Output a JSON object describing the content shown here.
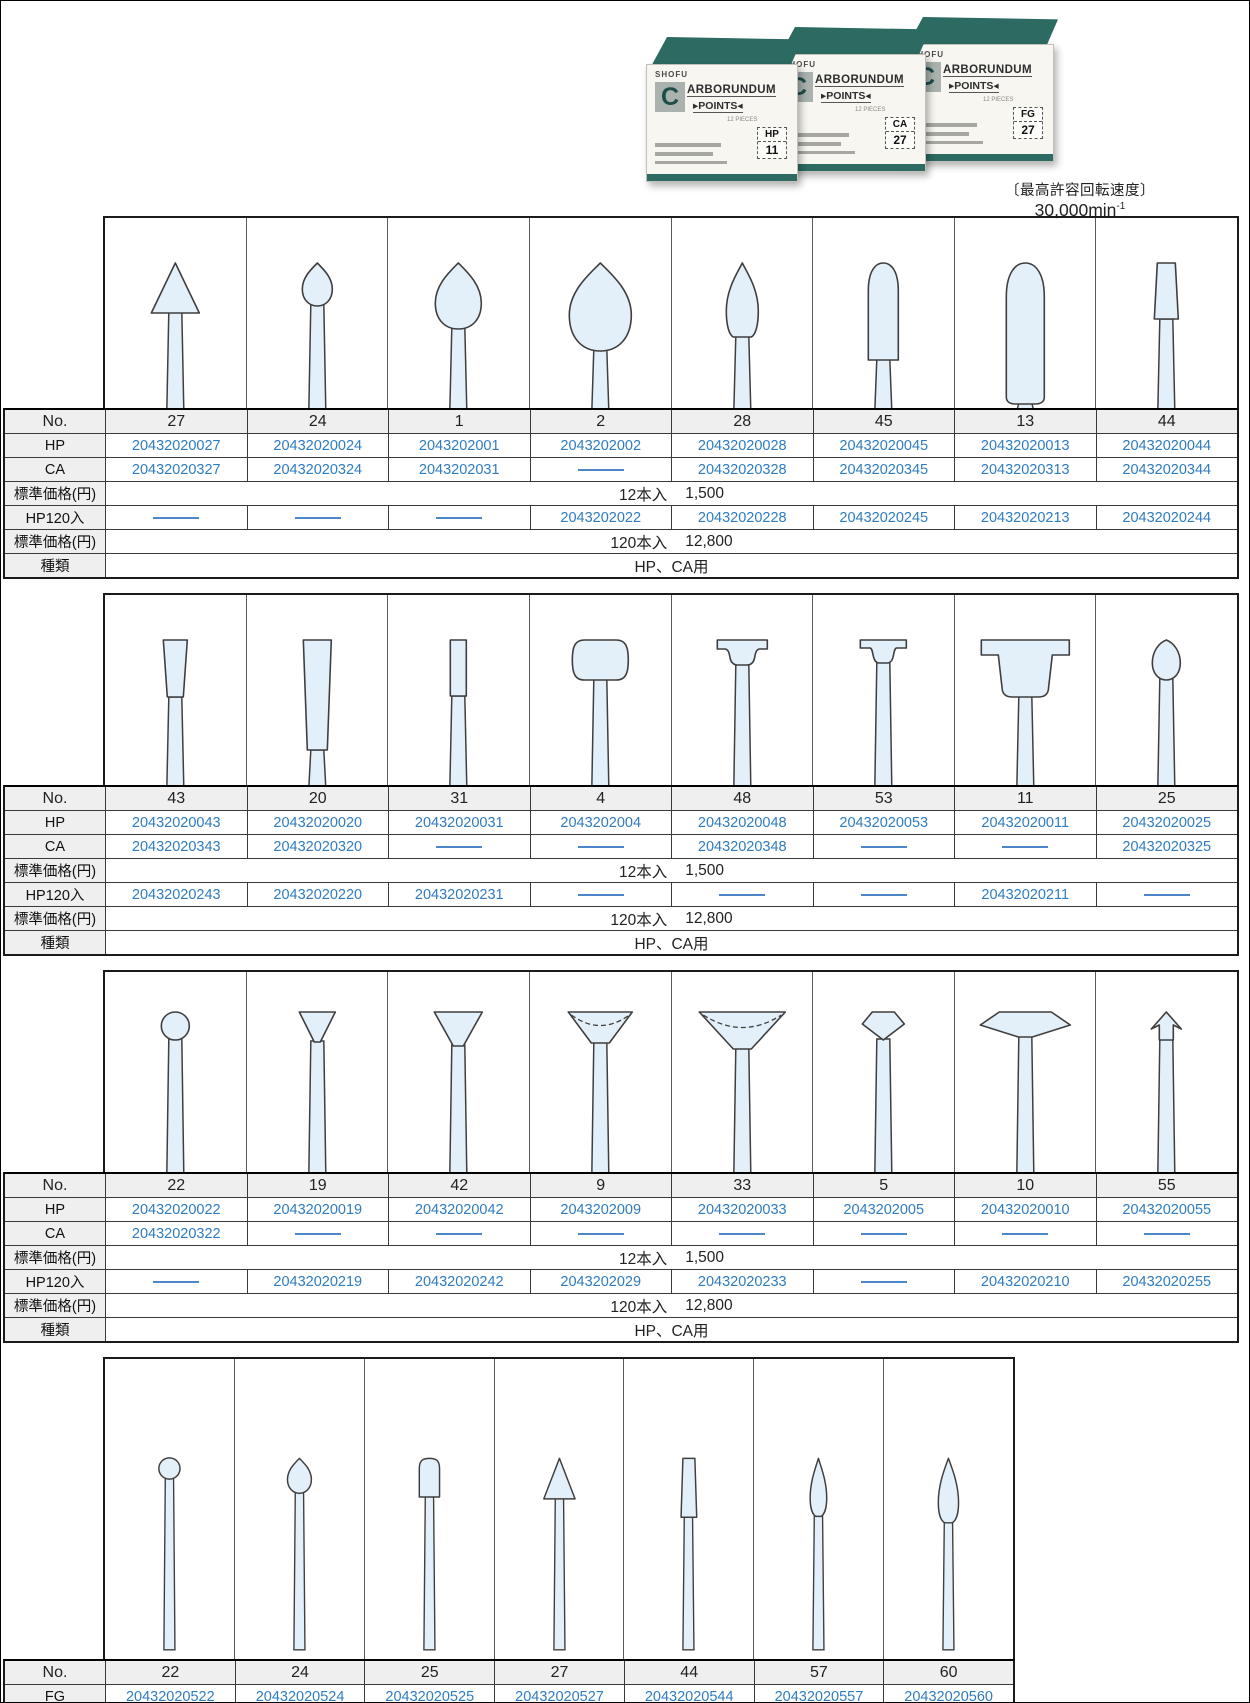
{
  "page": {
    "max_speed_label": "〔最高許容回転速度〕",
    "max_speed_value": "30,000min",
    "max_speed_sup": "-1"
  },
  "boxes": {
    "brand": "SHOFU",
    "logo_letter": "C",
    "product_line1": "ARBORUNDUM",
    "points_prefix": "▸",
    "product_line2": "POINTS",
    "points_suffix": "◂",
    "pieces": "12 PIECES",
    "items": [
      {
        "type": "HP",
        "no": "11"
      },
      {
        "type": "CA",
        "no": "27"
      },
      {
        "type": "FG",
        "no": "27"
      }
    ]
  },
  "labels": {
    "no": "No.",
    "hp": "HP",
    "ca": "CA",
    "fg": "FG",
    "price": "標準価格(円)",
    "hp120": "HP120入",
    "kind": "種類"
  },
  "tables": [
    {
      "kind": "HP、CA用",
      "price12": {
        "qty": "12本入",
        "value": "1,500"
      },
      "price120": {
        "qty": "120本入",
        "value": "12,800"
      },
      "columns": [
        {
          "no": "27",
          "shape": "cone",
          "hp": "20432020027",
          "ca": "20432020327",
          "hp120": null
        },
        {
          "no": "24",
          "shape": "drop_s",
          "hp": "20432020024",
          "ca": "20432020324",
          "hp120": null
        },
        {
          "no": "1",
          "shape": "drop_m",
          "hp": "2043202001",
          "ca": "2043202031",
          "hp120": null
        },
        {
          "no": "2",
          "shape": "drop_l",
          "hp": "2043202002",
          "ca": null,
          "hp120": "2043202022"
        },
        {
          "no": "28",
          "shape": "flame",
          "hp": "20432020028",
          "ca": "20432020328",
          "hp120": "20432020228"
        },
        {
          "no": "45",
          "shape": "bullet",
          "hp": "20432020045",
          "ca": "20432020345",
          "hp120": "20432020245"
        },
        {
          "no": "13",
          "shape": "torpedo",
          "hp": "20432020013",
          "ca": "20432020313",
          "hp120": "20432020213"
        },
        {
          "no": "44",
          "shape": "taper_s",
          "hp": "20432020044",
          "ca": "20432020344",
          "hp120": "20432020244"
        }
      ]
    },
    {
      "kind": "HP、CA用",
      "price12": {
        "qty": "12本入",
        "value": "1,500"
      },
      "price120": {
        "qty": "120本入",
        "value": "12,800"
      },
      "columns": [
        {
          "no": "43",
          "shape": "tapercyl_s",
          "hp": "20432020043",
          "ca": "20432020343",
          "hp120": "20432020243"
        },
        {
          "no": "20",
          "shape": "tapercyl_tall",
          "hp": "20432020020",
          "ca": "20432020320",
          "hp120": "20432020220"
        },
        {
          "no": "31",
          "shape": "cyl_narrow",
          "hp": "20432020031",
          "ca": null,
          "hp120": "20432020231"
        },
        {
          "no": "4",
          "shape": "wheel",
          "hp": "2043202004",
          "ca": null,
          "hp120": null
        },
        {
          "no": "48",
          "shape": "tflange_s",
          "hp": "20432020048",
          "ca": "20432020348",
          "hp120": null
        },
        {
          "no": "53",
          "shape": "tflange_m",
          "hp": "20432020053",
          "ca": null,
          "hp120": null
        },
        {
          "no": "11",
          "shape": "tflange_l",
          "hp": "20432020011",
          "ca": null,
          "hp120": "20432020211"
        },
        {
          "no": "25",
          "shape": "egg_s",
          "hp": "20432020025",
          "ca": "20432020325",
          "hp120": null
        }
      ]
    },
    {
      "kind": "HP、CA用",
      "price12": {
        "qty": "12本入",
        "value": "1,500"
      },
      "price120": {
        "qty": "120本入",
        "value": "12,800"
      },
      "columns": [
        {
          "no": "22",
          "shape": "ball",
          "hp": "20432020022",
          "ca": "20432020322",
          "hp120": null
        },
        {
          "no": "19",
          "shape": "invcone_s",
          "hp": "20432020019",
          "ca": null,
          "hp120": "20432020219"
        },
        {
          "no": "42",
          "shape": "invcone_m",
          "hp": "20432020042",
          "ca": null,
          "hp120": "20432020242"
        },
        {
          "no": "9",
          "shape": "cup_m",
          "hp": "2043202009",
          "ca": null,
          "hp120": "2043202029"
        },
        {
          "no": "33",
          "shape": "cup_l",
          "hp": "20432020033",
          "ca": null,
          "hp120": "20432020233"
        },
        {
          "no": "5",
          "shape": "hex_s",
          "hp": "2043202005",
          "ca": null,
          "hp120": null
        },
        {
          "no": "10",
          "shape": "lens_w",
          "hp": "20432020010",
          "ca": null,
          "hp120": "20432020210"
        },
        {
          "no": "55",
          "shape": "arrow_s",
          "hp": "20432020055",
          "ca": null,
          "hp120": "20432020255"
        }
      ]
    },
    {
      "kind": "FG用",
      "price12": {
        "qty": "12本入",
        "value": "1,500"
      },
      "columns": [
        {
          "no": "22",
          "shape": "ball4",
          "fg": "20432020522"
        },
        {
          "no": "24",
          "shape": "drop4",
          "fg": "20432020524"
        },
        {
          "no": "25",
          "shape": "roundcyl4",
          "fg": "20432020525"
        },
        {
          "no": "27",
          "shape": "cone4",
          "fg": "20432020527"
        },
        {
          "no": "44",
          "shape": "taper4",
          "fg": "20432020544"
        },
        {
          "no": "57",
          "shape": "flame4_s",
          "fg": "20432020557"
        },
        {
          "no": "60",
          "shape": "flame4_l",
          "fg": "20432020560"
        }
      ]
    }
  ]
}
